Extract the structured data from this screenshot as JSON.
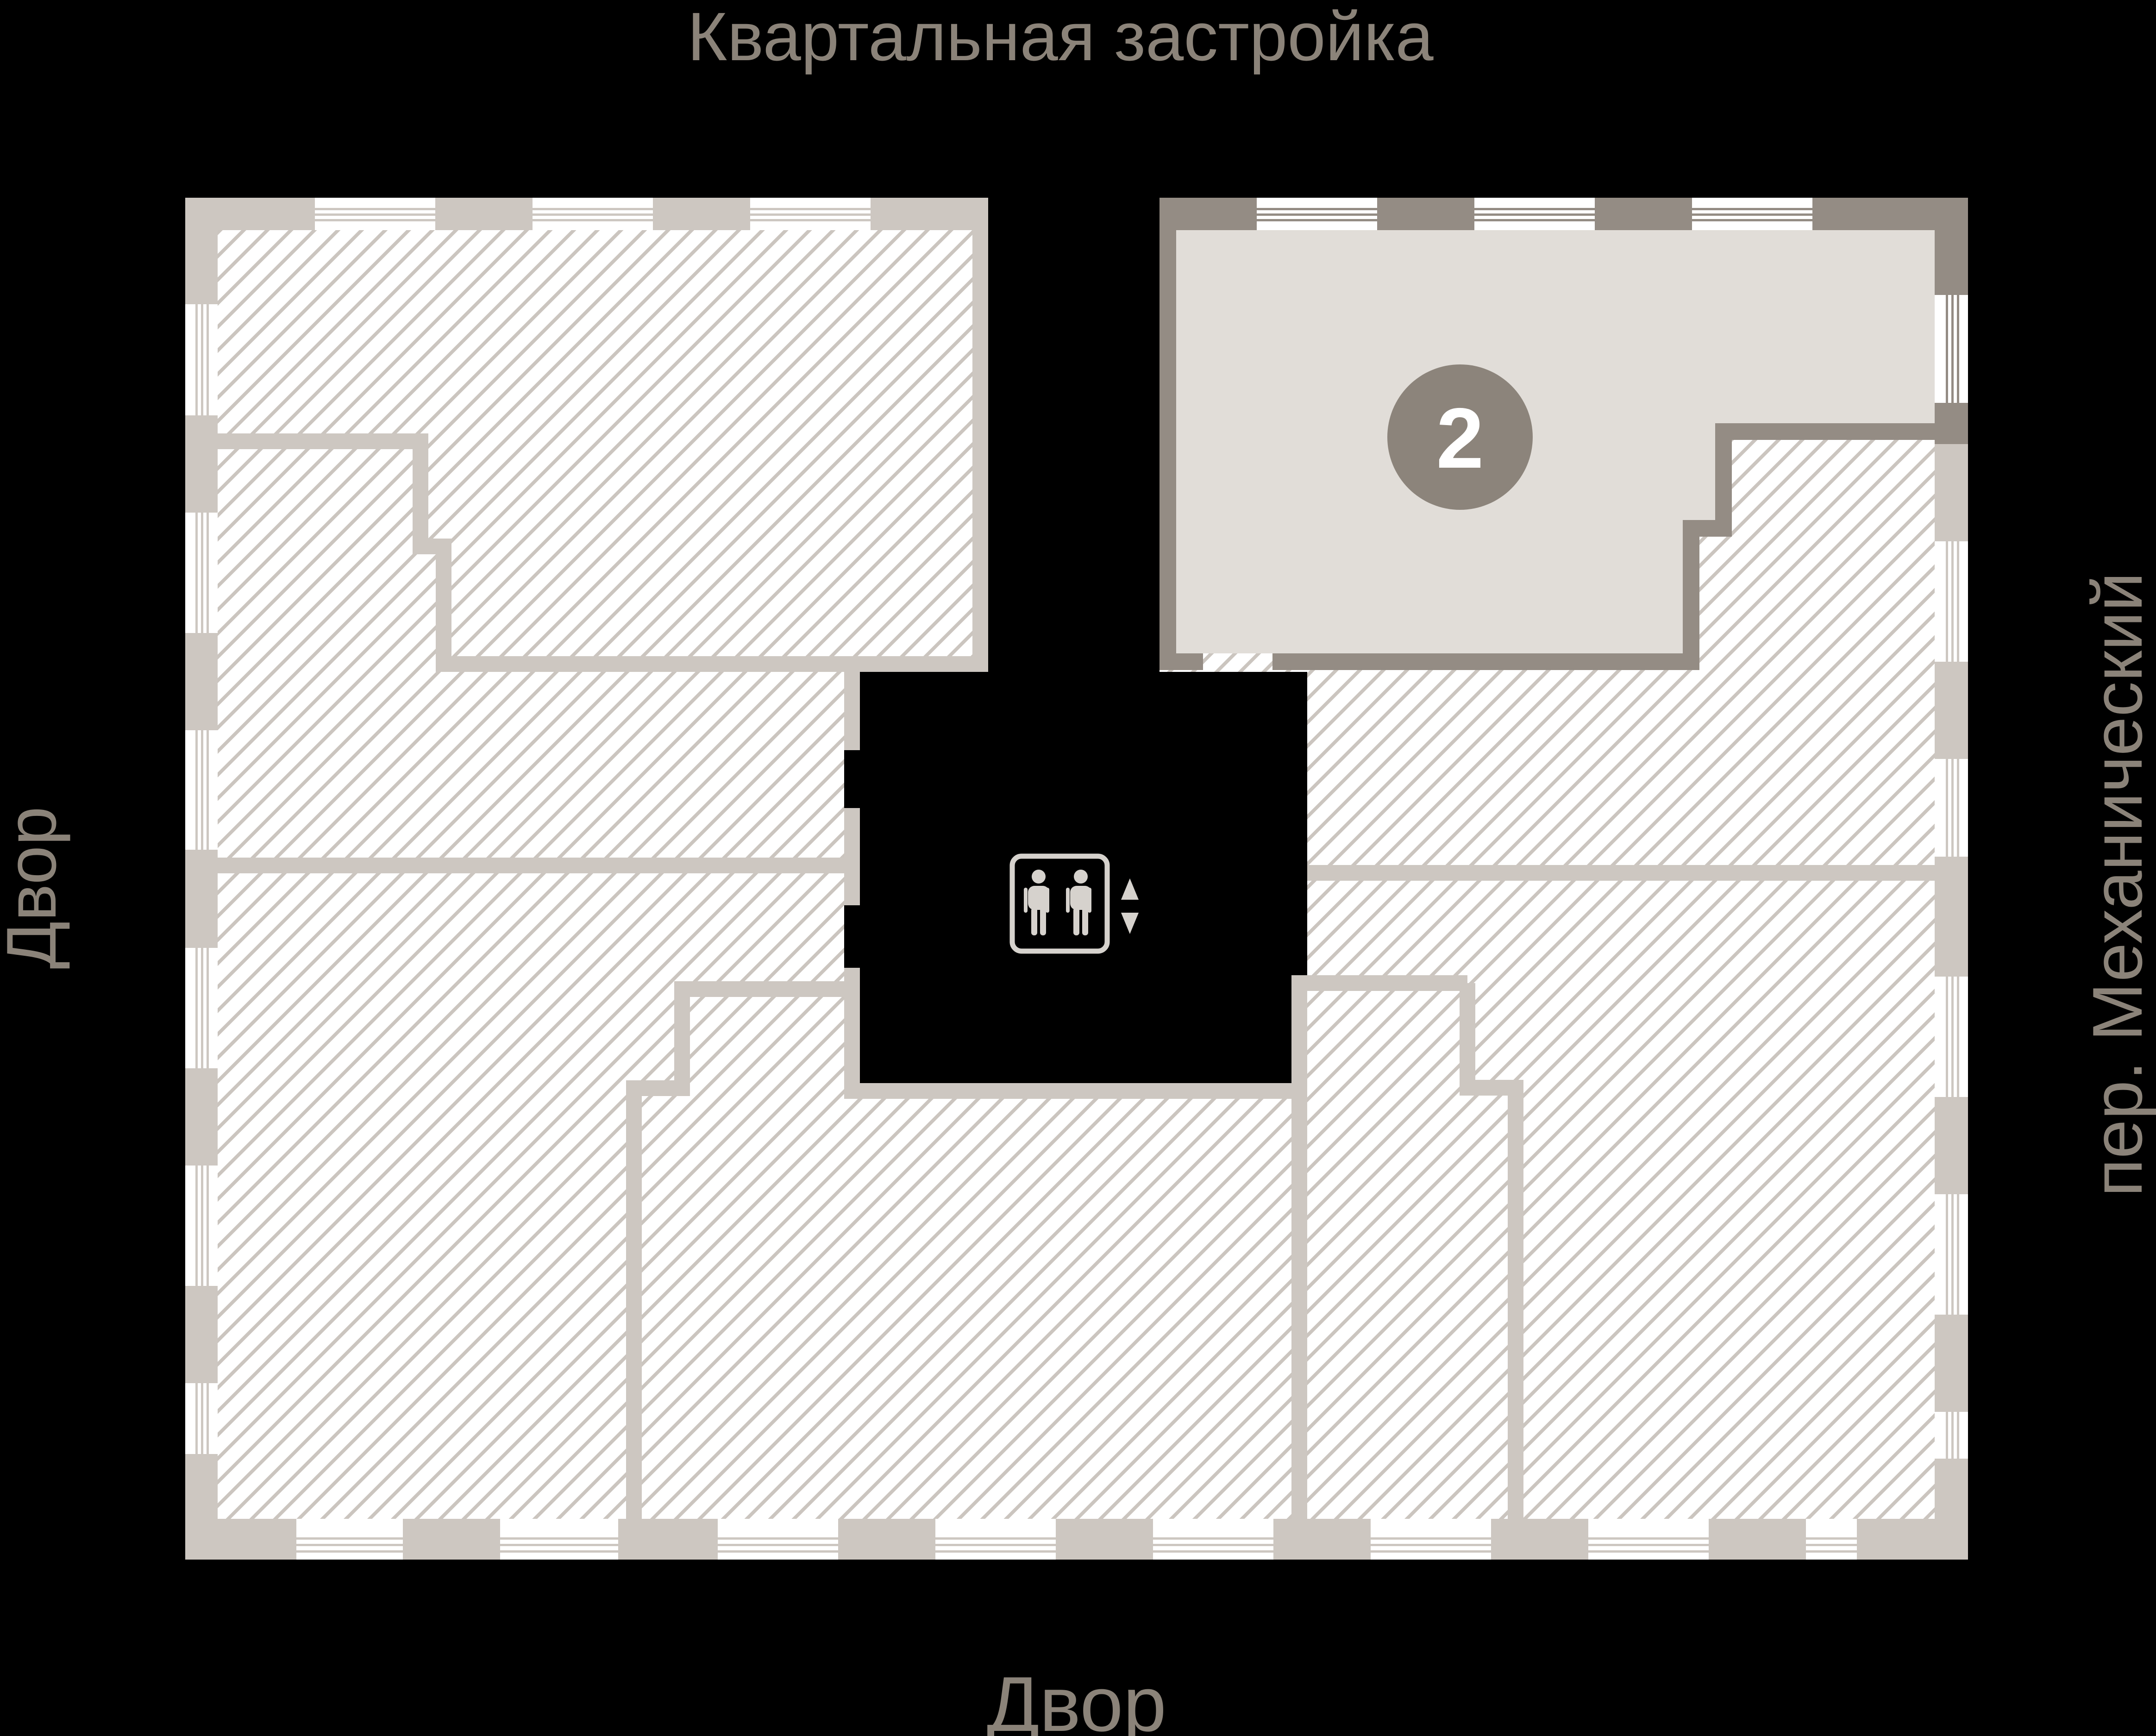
{
  "labels": {
    "top": "Квартальная застройка",
    "left": "Двор",
    "right": "пер. Механический",
    "bottom": "Двор"
  },
  "apartment": {
    "number": "2",
    "status": "highlighted"
  },
  "icons": {
    "elevator": "elevator-icon",
    "up_arrow": "triangle-up",
    "down_arrow": "triangle-down"
  },
  "theme": {
    "background": "#000000",
    "label_text": "#8b8379",
    "wall_light": "#cdc7c1",
    "wall_dark": "#948c84",
    "hatch_line": "#cbc5bf",
    "hatch_bg": "#ffffff",
    "unit2_fill": "#e1ddd8",
    "unit2_badge": "#8c847b",
    "badge_text": "#ffffff",
    "core": "#000000",
    "elevator_icon": "#d6d2cd"
  }
}
